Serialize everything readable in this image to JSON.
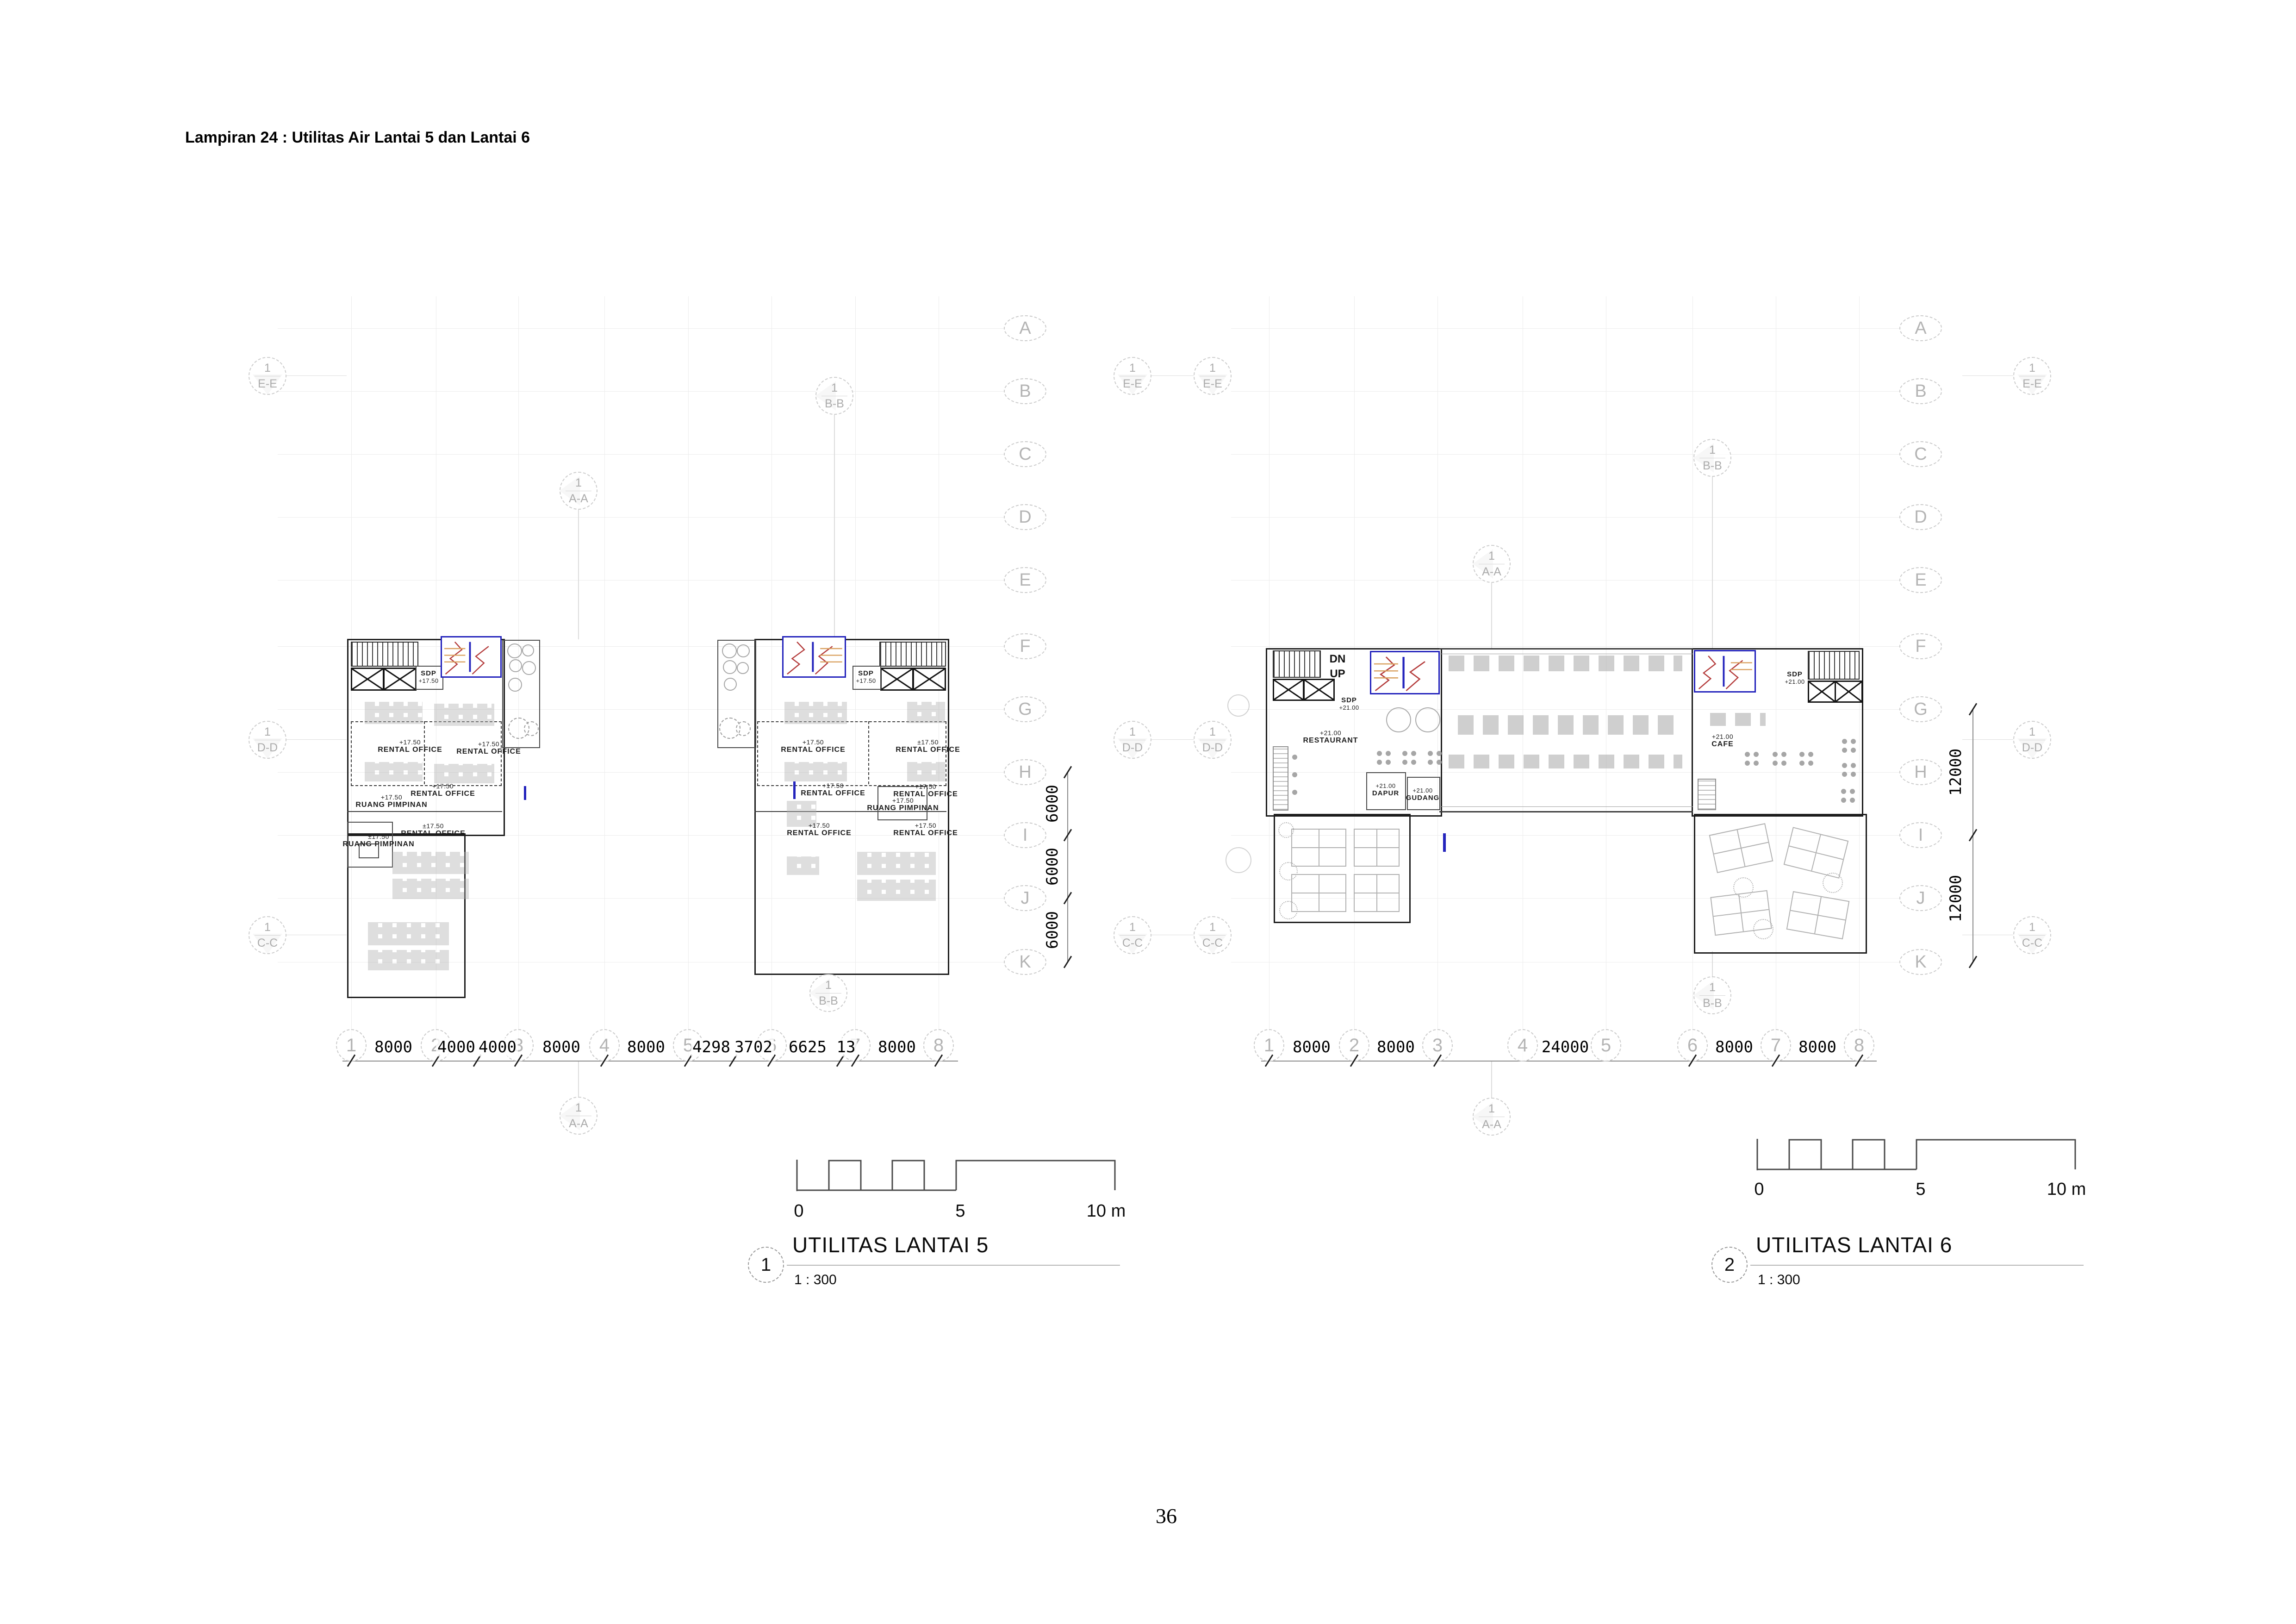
{
  "page": {
    "heading": "Lampiran 24 : Utilitas Air Lantai 5 dan Lantai 6",
    "page_number": "36"
  },
  "grid": {
    "letters": [
      "A",
      "B",
      "C",
      "D",
      "E",
      "F",
      "G",
      "H",
      "I",
      "J",
      "K"
    ],
    "numbers": [
      "1",
      "2",
      "3",
      "4",
      "5",
      "6",
      "7",
      "8"
    ]
  },
  "sections": {
    "ref": "1",
    "aa": "A-A",
    "bb": "B-B",
    "cc": "C-C",
    "dd": "D-D",
    "ee": "E-E"
  },
  "scale_bar": {
    "zero": "0",
    "five": "5",
    "ten": "10 m"
  },
  "plan5": {
    "ref": "1",
    "title": "UTILITAS LANTAI 5",
    "scale": "1 : 300",
    "dims_bottom": [
      "8000",
      "4000",
      "4000",
      "8000",
      "8000",
      "4298",
      "3702",
      "6625",
      "13",
      "8000"
    ],
    "dims_right": [
      "6000",
      "6000",
      "6000"
    ],
    "rooms": {
      "sdp_a": {
        "name": "SDP",
        "elev": "+17.50"
      },
      "sdp_b": {
        "name": "SDP",
        "elev": "+17.50"
      },
      "ro_a1": {
        "elev": "+17.50",
        "name": "RENTAL OFFICE"
      },
      "ro_a2": {
        "elev": "+17.50",
        "name": "RENTAL OFFICE"
      },
      "ro_a3": {
        "elev": "+17.50",
        "name": "RENTAL OFFICE"
      },
      "rp_a1": {
        "elev": "+17.50",
        "name": "RUANG PIMPINAN"
      },
      "ro_a4": {
        "elev": "±17.50",
        "name": "RENTAL OFFICE"
      },
      "rp_a2": {
        "elev": "±17.50",
        "name": "RUANG PIMPINAN"
      },
      "ro_b1": {
        "elev": "+17.50",
        "name": "RENTAL OFFICE"
      },
      "ro_b2": {
        "elev": "±17.50",
        "name": "RENTAL OFFICE"
      },
      "ro_b3": {
        "elev": "+17.50",
        "name": "RENTAL OFFICE"
      },
      "ro_b4": {
        "elev": "+17.50",
        "name": "RENTAL OFFICE"
      },
      "rp_b1": {
        "elev": "+17.50",
        "name": "RUANG PIMPINAN"
      },
      "ro_b5": {
        "elev": "+17.50",
        "name": "RENTAL OFFICE"
      },
      "ro_b6": {
        "elev": "+17.50",
        "name": "RENTAL OFFICE"
      }
    }
  },
  "plan6": {
    "ref": "2",
    "title": "UTILITAS LANTAI 6",
    "scale": "1 : 300",
    "dims_bottom": [
      "8000",
      "8000",
      "24000",
      "8000",
      "8000"
    ],
    "dims_right": [
      "12000",
      "12000"
    ],
    "rooms": {
      "stair_dn": "DN",
      "stair_up": "UP",
      "sdp_l": {
        "name": "SDP",
        "elev": "+21.00"
      },
      "restaurant": {
        "elev": "+21.00",
        "name": "RESTAURANT"
      },
      "dapur": {
        "elev": "+21.00",
        "name": "DAPUR"
      },
      "gudang": {
        "elev": "+21.00",
        "name": "GUDANG"
      },
      "sdp_r": {
        "name": "SDP",
        "elev": "+21.00"
      },
      "cafe": {
        "elev": "+21.00",
        "name": "CAFE"
      }
    }
  },
  "colors": {
    "pipe_blue": "#2323bc",
    "pipe_red": "#b43c3c",
    "pipe_orange": "#d9a05f",
    "grid_gray": "#cbcbcb"
  }
}
